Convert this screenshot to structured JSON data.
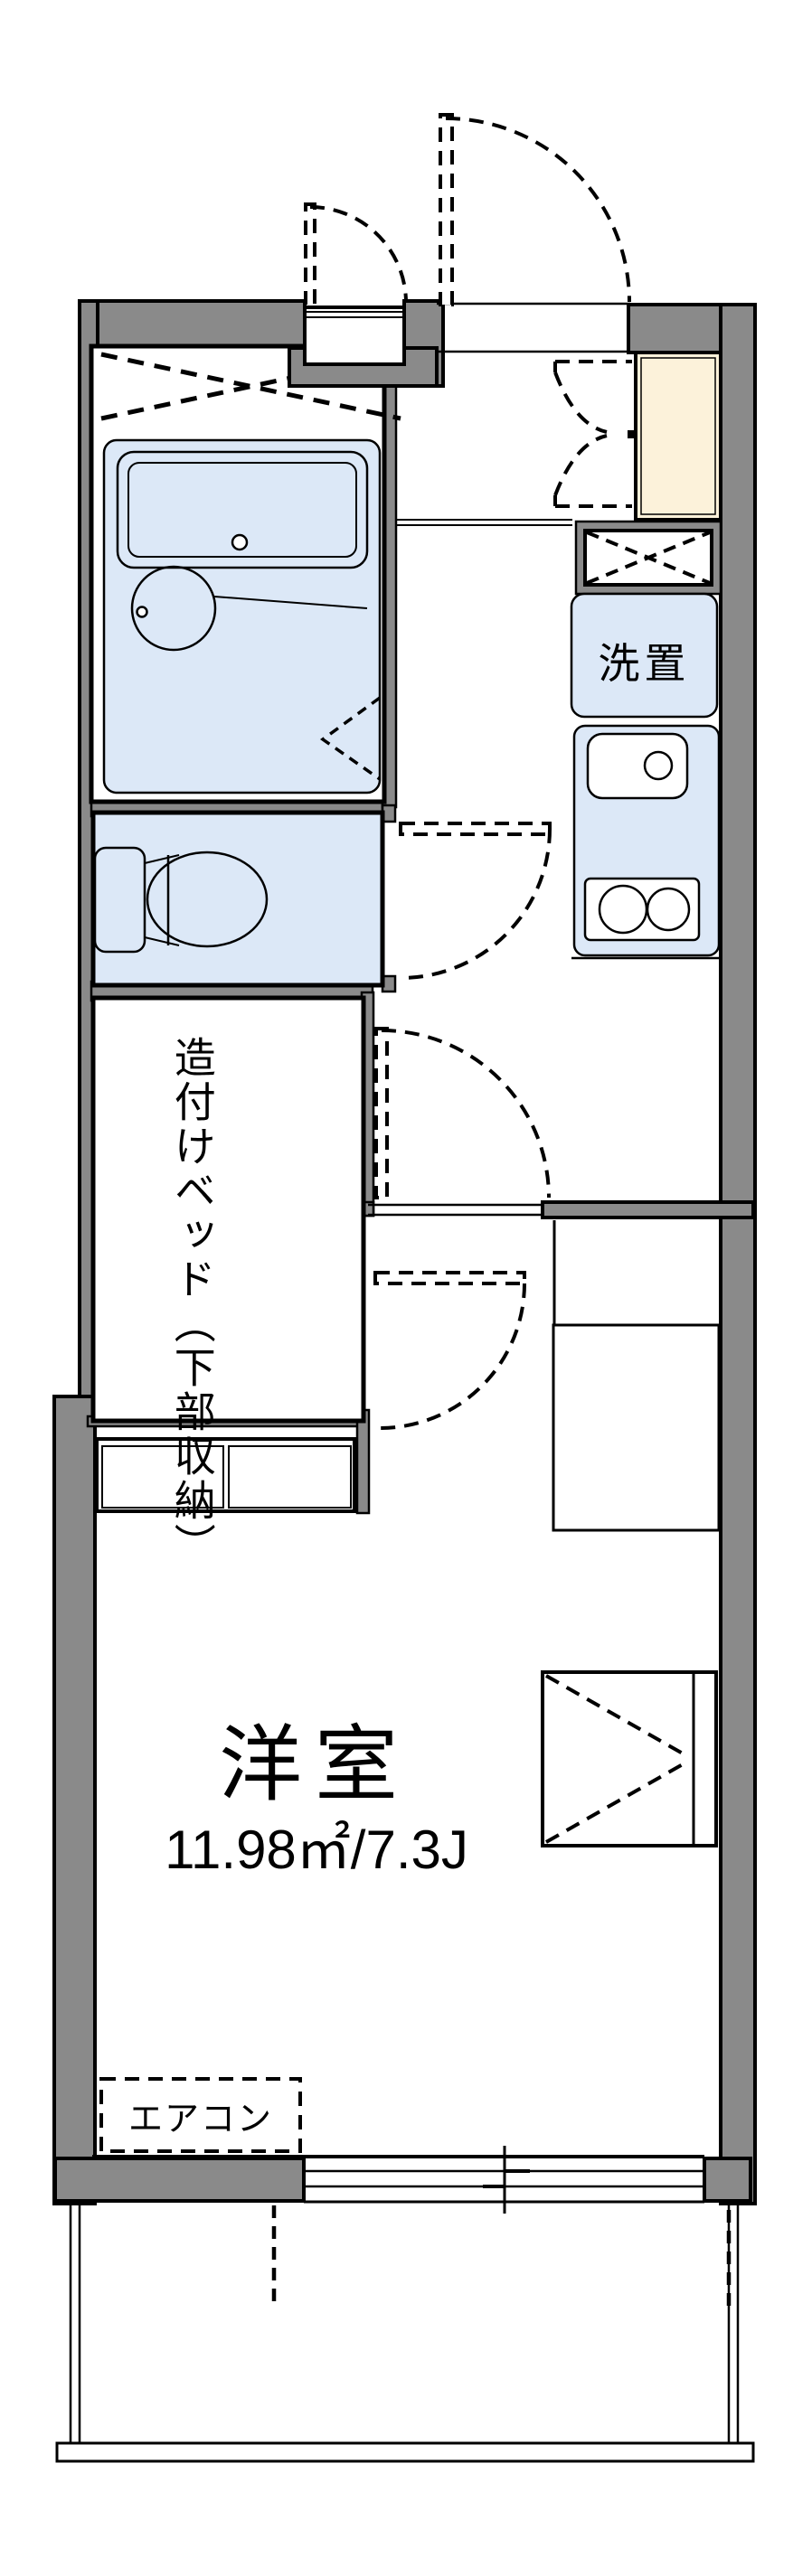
{
  "floorplan": {
    "labels": {
      "laundry": "洗置",
      "bed_line1": "造付けベッド",
      "bed_line2": "（下部収納）",
      "room_name": "洋室",
      "room_area": "11.98㎡/7.3J",
      "aircon": "エアコン"
    },
    "room": {
      "name": "洋室",
      "area_m2": "11.98",
      "area_jo": "7.3"
    },
    "colors": {
      "wall": "#8a8a8a",
      "fixture_blue": "#dce8f7",
      "cabinet_beige": "#fcf2da",
      "line": "#000000",
      "background": "#ffffff"
    },
    "fixtures": [
      "bathtub",
      "wash-basin",
      "toilet",
      "washing-machine-space",
      "kitchen-sink",
      "two-burner-stove",
      "shoe-cabinet",
      "overhead-cabinet",
      "built-in-bed",
      "under-bed-drawers",
      "closet",
      "air-conditioner",
      "sliding-window",
      "balcony"
    ]
  }
}
